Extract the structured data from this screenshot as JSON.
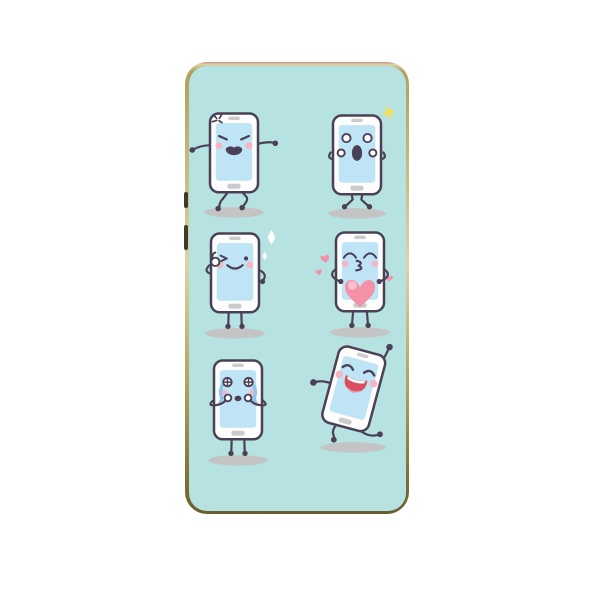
{
  "product": {
    "type": "phone-case",
    "pattern": "cartoon smartphone emoji characters",
    "frame_style": "thin gold metallic bumper with side buttons and bottom cutouts",
    "backdrop": "plain white studio background"
  },
  "colors": {
    "page_background": "#ffffff",
    "case_background": "#b6e3e1",
    "frame_top_tint": "#c98f8a",
    "frame_gold_light": "#dcd4a4",
    "frame_gold": "#b0a159",
    "frame_gold_dark": "#6b5e2e",
    "side_button": "#3e3a2c",
    "outline": "#4a4156",
    "phone_body": "#fdfdfd",
    "screen_blue": "#bfe4f5",
    "detail_grey": "#cbcbcb",
    "cheek_pink": "#f3b6c3",
    "heart_pink": "#f392a7",
    "heart_pink_light": "#f9bfca",
    "tear_blue": "#8dc6ec",
    "sparkle_yellow": "#eedf5e",
    "sparkle_white": "#ffffff",
    "shadow_grey": "#c4c4c4",
    "laugh_mouth_red": "#d8505f",
    "tongue_pink": "#f193a0"
  },
  "characters": [
    {
      "id": "angry-phone",
      "emotion": "angry",
      "pose": "arms out, stomping walk",
      "decorations": [
        "anger-mark"
      ],
      "row": 1,
      "column": 1
    },
    {
      "id": "shocked-phone",
      "emotion": "shocked",
      "pose": "hands raised to face, knock-kneed",
      "decorations": [
        "yellow-sparkle"
      ],
      "row": 1,
      "column": 2
    },
    {
      "id": "winking-phone",
      "emotion": "winking",
      "pose": "thumbs-up by face",
      "decorations": [
        "white-diamond-sparkles"
      ],
      "row": 2,
      "column": 1
    },
    {
      "id": "kissing-phone",
      "emotion": "kissing",
      "pose": "holding big heart",
      "decorations": [
        "big-heart",
        "floating-hearts"
      ],
      "row": 2,
      "column": 2
    },
    {
      "id": "crying-phone",
      "emotion": "crying",
      "pose": "fists at mouth, sobbing",
      "decorations": [
        "tear-streams",
        "starry-eyes"
      ],
      "row": 3,
      "column": 1
    },
    {
      "id": "laughing-phone",
      "emotion": "laughing",
      "pose": "dancing, tilted, one arm up",
      "decorations": [],
      "row": 3,
      "column": 2
    }
  ]
}
